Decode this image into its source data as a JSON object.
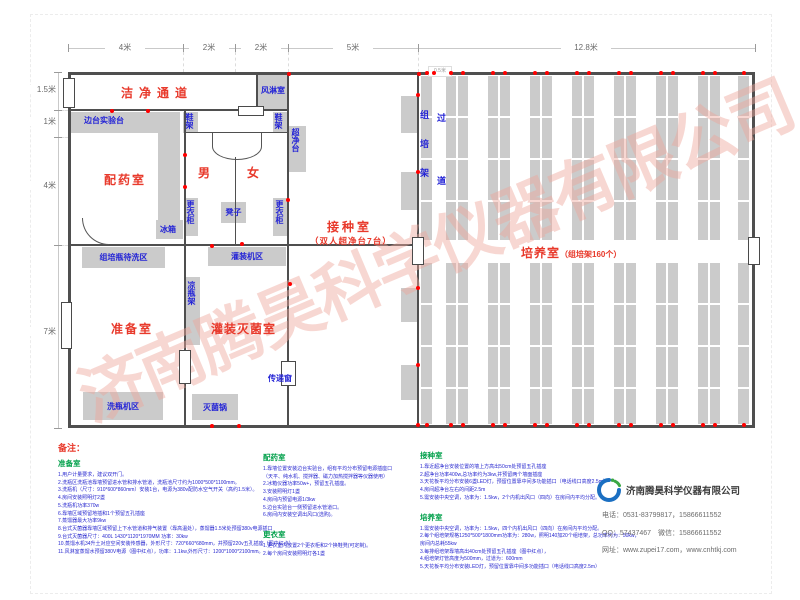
{
  "dims": {
    "top": [
      "4米",
      "2米",
      "2米",
      "5米",
      "12.8米"
    ],
    "left": [
      "1.5米",
      "1米",
      "4米",
      "7米"
    ],
    "shelf": "0.5米"
  },
  "rooms": {
    "corridor": "洁净通道",
    "air_shower": "风淋室",
    "dispensing": "配药室",
    "male": "男",
    "female": "女",
    "inoculation": "接种室",
    "inoculation_sub": "（双人超净台7台）",
    "prep": "准备室",
    "filling": "灌装灭菌室",
    "culture": "培养室",
    "culture_sub": "（组培架160个）"
  },
  "furniture": {
    "side_bench": "边台实验台",
    "shoe_rack": "鞋架",
    "clean_bench": "超净台",
    "wardrobe": "更衣柜",
    "stool": "凳子",
    "fridge": "冰箱",
    "bottle_wait_area": "组培瓶待洗区",
    "filling_area": "灌装机区",
    "cool_rack": "凉瓶架",
    "washer_area": "洗瓶机区",
    "autoclave": "灭菌锅",
    "pass_window": "传递窗",
    "rack_vertical": "组培架",
    "aisle_vertical": "过道"
  },
  "notes": {
    "heading": "备注：",
    "sections": [
      {
        "title": "准备室",
        "lines": [
          "1.用户计量要求，建议双开门。",
          "2.洗瓶区洗瓶池靠墙预留进水管和排水管道，洗瓶池尺寸约为1000*500*1100mm。",
          "3.洗瓶机（尺寸：910*600*860mm）安装1台，电源为380v配防水空气开关（高约1.5米）。",
          "4.房间安装照明灯2盏",
          "5.洗瓶机功率370w",
          "6.靠墙区域预留地插和1个预留五孔插座",
          "7.蒸馏器最大功率9kw",
          "8.台式灭菌器靠墙区域预留上下水管道和排气装置（靠高温处），蒸馏器1.5米处预留380v电源插口",
          "9.台式灭菌器尺寸：400L  1430*1120*1970MM  功率：30kw",
          "10.蒸馏水机34升土对应空间安装传感器，外形尺寸：720*660*680mm，并预留220v五孔插座（图中红点）",
          "11.风淋室蒸馏水预留380V电源（图中红点），功率：1.1kw,外形尺寸：1200*1000*2100mm。"
        ]
      },
      {
        "title": "配药室",
        "lines": [
          "1.靠墙位置安装边台实验台，组有平均分布预留电源插座口",
          "（天平、纯水机、搅拌器、磁力加热搅拌器等仪器使用）",
          "2.冰箱仪器功率50w+，预留五孔插座。",
          "3.安装照明灯1盏",
          "4.房间内预留电源1/3kw",
          "5.边台实验台一侧预留进水管道口。",
          "6.房间内安装空调出风口(选购)。"
        ]
      },
      {
        "title": "更衣室",
        "lines": [
          "1.更衣室内放置2个更衣柜和2个换鞋凳(可定制)。",
          "2.每个房间安装照明灯各1盏"
        ]
      },
      {
        "title": "接种室",
        "lines": [
          "1.靠近超净台安装位置的墙上方高出50cm处预留五孔插座",
          "2.超净台功率400w,总功率约为3kw,并预留两个墙面插座",
          "3.天花板平均分布安装6盏LED灯，预留位置靠中间多功能插口（电话线口高度2.5m）",
          "4.房间超净台左右的间距2.5m",
          "5.需安装中央空调，功率为：1.5kw，2个内机出风口（四向）在房间内平均分配。"
        ]
      },
      {
        "title": "培养室",
        "lines": [
          "1.需安装中央空调，功率为：1.5kw，四个内机出风口（四向）在房间内平均分配。",
          "2.每个组培架规格1250*500*1800mm功率为：280w，照明140加20个组培架，总功率约为：50kw，",
          "房间内总耗55kw",
          "3.每排组培架靠墙高出40cm处预留五孔插座（图中红点），",
          "4.组培架灯管高度为500mm，过道为：600mm",
          "5.天花板平均分布安装LED灯，预留位置靠中间多功能插口（电话线口高度2.5m）"
        ]
      }
    ]
  },
  "company": {
    "name": "济南腾昊科学仪器有限公司",
    "phone": "电话：0531-83799817，15866611552",
    "qq": "QQ：57437467　微信：15866611552",
    "web": "网址：www.zupei17.com，www.cnhtkj.com"
  },
  "watermark": "济南腾昊科学仪器有限公司",
  "colors": {
    "room_label": "#e8392b",
    "furniture_label": "#2424d6",
    "note_header": "#00a04a",
    "note_text": "#2828cf",
    "wall": "#4f4f4f",
    "furniture_fill": "#cbcbcb",
    "socket_dot": "#ff0000",
    "watermark": "#eea69c"
  }
}
